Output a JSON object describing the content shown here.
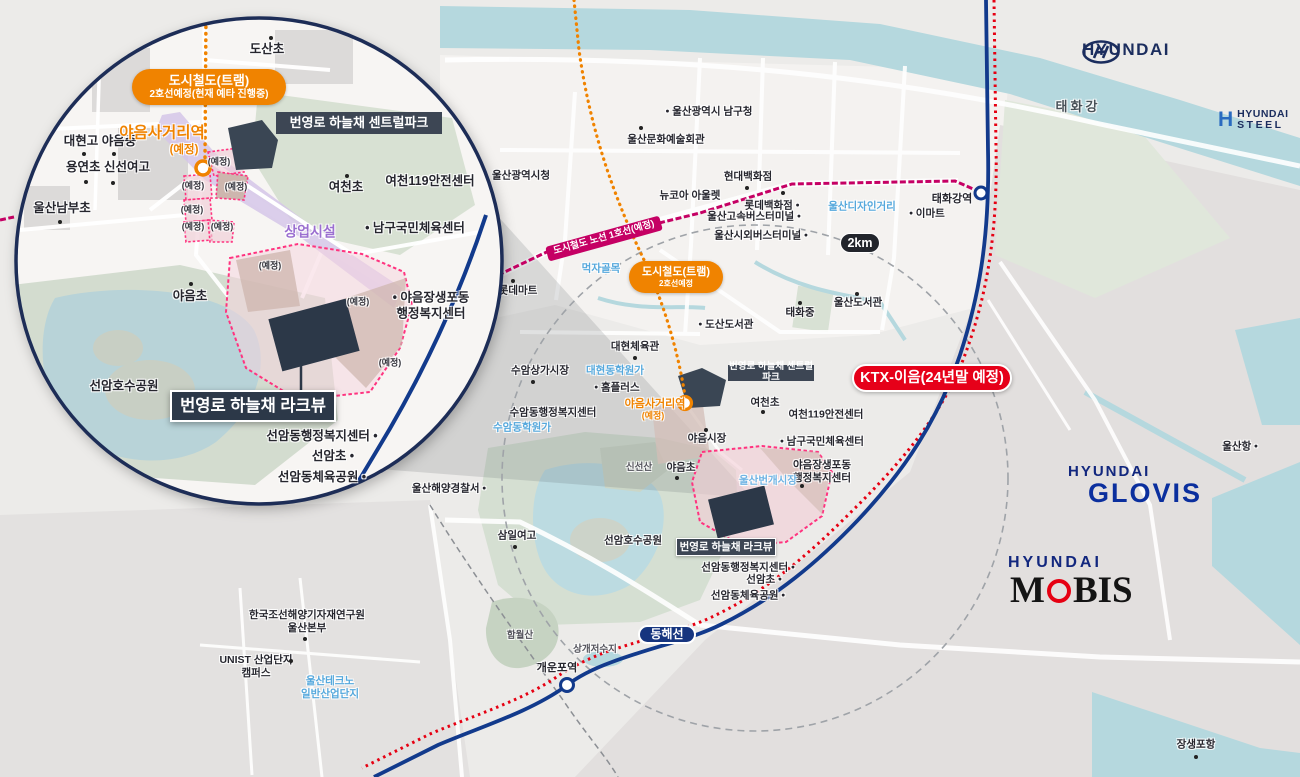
{
  "badges": {
    "inset_tram_l1": "도시철도(트램)",
    "inset_tram_l2": "2호선예정(현재 예타 진행중)",
    "map_tram_l1": "도시철도(트램)",
    "map_tram_l2": "2호선예정",
    "line1": "도시철도 노선 1호선(예정)",
    "centralpark": "번영로 하늘채 센트럴파크",
    "lakeview": "번영로 하늘채 라크뷰",
    "ktx": "KTX-이음(24년말 예정)",
    "donghae": "동해선",
    "km": "2km"
  },
  "stations": {
    "yaeum": "야음사거리역",
    "yaeum_note": "(예정)",
    "taehwagang": "태화강역",
    "gaeunpo": "개운포역"
  },
  "logos": {
    "hyundai": "HYUNDAI",
    "steel_l1": "HYUNDAI",
    "steel_l2": "STEEL",
    "steel_h": "H",
    "glovis_l1": "HYUNDAI",
    "glovis_l2": "GLOVIS",
    "mobis_l1": "HYUNDAI",
    "mobis_m": "M",
    "mobis_bis": "BIS"
  },
  "colors": {
    "orange": "#f08300",
    "magenta_line": "#c50064",
    "rail_blue": "#123a8c",
    "rail_red": "#e60012",
    "badge_dark": "#3d4654",
    "ktx_red": "#e60019",
    "donghae_navy": "#16357f",
    "parcel_pink": "#ff337f",
    "commercial_purple": "#d5c6e8",
    "water": "#b5d8de"
  },
  "map_labels": [
    {
      "t": "울산광역시청",
      "x": 521,
      "y": 176
    },
    {
      "t": "울산광역시 남구청",
      "x": 709,
      "y": 112,
      "d": "l"
    },
    {
      "t": "울산문화예술회관",
      "x": 666,
      "y": 140
    },
    {
      "t": "",
      "x": 641,
      "y": 128,
      "c": "dot"
    },
    {
      "t": "울산디자인거리",
      "x": 862,
      "y": 207,
      "c": "b"
    },
    {
      "t": "현대백화점",
      "x": 748,
      "y": 177
    },
    {
      "t": "",
      "x": 747,
      "y": 188,
      "c": "dot"
    },
    {
      "t": "뉴코아 아울렛",
      "x": 690,
      "y": 196
    },
    {
      "t": "",
      "x": 783,
      "y": 193,
      "c": "dot"
    },
    {
      "t": "롯데백화점",
      "x": 772,
      "y": 206,
      "d": "r"
    },
    {
      "t": "울산고속버스터미널",
      "x": 754,
      "y": 217,
      "d": "r"
    },
    {
      "t": "울산시외버스터미널",
      "x": 761,
      "y": 236,
      "d": "r"
    },
    {
      "t": "먹자골목",
      "x": 601,
      "y": 269,
      "c": "b"
    },
    {
      "t": "롯데마트",
      "x": 518,
      "y": 291
    },
    {
      "t": "",
      "x": 513,
      "y": 281,
      "c": "dot"
    },
    {
      "t": "울산도서관",
      "x": 858,
      "y": 303
    },
    {
      "t": "",
      "x": 857,
      "y": 294,
      "c": "dot"
    },
    {
      "t": "태화중",
      "x": 800,
      "y": 313
    },
    {
      "t": "",
      "x": 800,
      "y": 303,
      "c": "dot"
    },
    {
      "t": "도산도서관",
      "x": 726,
      "y": 325,
      "d": "l"
    },
    {
      "t": "대현체육관",
      "x": 635,
      "y": 347
    },
    {
      "t": "",
      "x": 635,
      "y": 358,
      "c": "dot"
    },
    {
      "t": "수암상가시장",
      "x": 540,
      "y": 371
    },
    {
      "t": "",
      "x": 533,
      "y": 382,
      "c": "dot"
    },
    {
      "t": "대현동학원가",
      "x": 615,
      "y": 371,
      "c": "b"
    },
    {
      "t": "홈플러스",
      "x": 617,
      "y": 388,
      "d": "l"
    },
    {
      "t": "수암동행정복지센터",
      "x": 553,
      "y": 413
    },
    {
      "t": "수암동학원가",
      "x": 522,
      "y": 428,
      "c": "b"
    },
    {
      "t": "야음사거리역",
      "x": 655,
      "y": 405,
      "c": "o"
    },
    {
      "t": "(예정)",
      "x": 653,
      "y": 416,
      "c": "o2"
    },
    {
      "t": "야음시장",
      "x": 707,
      "y": 439
    },
    {
      "t": "",
      "x": 706,
      "y": 430,
      "c": "dot"
    },
    {
      "t": "신선산",
      "x": 639,
      "y": 468,
      "c": "sm"
    },
    {
      "t": "야음초",
      "x": 681,
      "y": 468
    },
    {
      "t": "",
      "x": 677,
      "y": 478,
      "c": "dot"
    },
    {
      "t": "여천초",
      "x": 765,
      "y": 403
    },
    {
      "t": "",
      "x": 763,
      "y": 412,
      "c": "dot"
    },
    {
      "t": "여천119안전센터",
      "x": 826,
      "y": 415
    },
    {
      "t": "남구국민체육센터",
      "x": 822,
      "y": 442,
      "d": "l"
    },
    {
      "t": "야음장생포동\n행정복지센터",
      "x": 822,
      "y": 472
    },
    {
      "t": "",
      "x": 802,
      "y": 486,
      "c": "dot"
    },
    {
      "t": "울산번개시장",
      "x": 768,
      "y": 481,
      "c": "bw"
    },
    {
      "t": "태화강역",
      "x": 952,
      "y": 200,
      "c": "sta"
    },
    {
      "t": "이마트",
      "x": 927,
      "y": 214,
      "d": "l"
    },
    {
      "t": "울산항",
      "x": 1240,
      "y": 447,
      "d": "r"
    },
    {
      "t": "삼일여고",
      "x": 517,
      "y": 536
    },
    {
      "t": "",
      "x": 515,
      "y": 547,
      "c": "dot"
    },
    {
      "t": "선암호수공원",
      "x": 633,
      "y": 541
    },
    {
      "t": "선암동행정복지센터",
      "x": 748,
      "y": 568,
      "d": "r"
    },
    {
      "t": "선암초",
      "x": 764,
      "y": 580,
      "d": "r"
    },
    {
      "t": "선암동체육공원",
      "x": 748,
      "y": 596,
      "d": "r"
    },
    {
      "t": "울산해양경찰서",
      "x": 449,
      "y": 489,
      "d": "r"
    },
    {
      "t": "함월산",
      "x": 520,
      "y": 636,
      "c": "sm"
    },
    {
      "t": "상개저수지",
      "x": 595,
      "y": 650,
      "c": "sm"
    },
    {
      "t": "개운포역",
      "x": 557,
      "y": 669,
      "c": "sta"
    },
    {
      "t": "한국조선해양기자재연구원\n울산본부",
      "x": 307,
      "y": 622
    },
    {
      "t": "",
      "x": 305,
      "y": 639,
      "c": "dot"
    },
    {
      "t": "UNIST 산업단지\n캠퍼스",
      "x": 256,
      "y": 667
    },
    {
      "t": "",
      "x": 291,
      "y": 661,
      "c": "dot"
    },
    {
      "t": "울산테크노\n일반산업단지",
      "x": 330,
      "y": 688,
      "c": "b"
    },
    {
      "t": "장생포항",
      "x": 1196,
      "y": 745
    },
    {
      "t": "",
      "x": 1196,
      "y": 757,
      "c": "dot"
    },
    {
      "t": "태화강",
      "x": 1078,
      "y": 107,
      "c": "rv"
    }
  ],
  "inset_labels": [
    {
      "t": "도산초",
      "x": 267,
      "y": 50,
      "c": "i"
    },
    {
      "t": "",
      "x": 271,
      "y": 38,
      "c": "dot"
    },
    {
      "t": "대현고  야음중",
      "x": 100,
      "y": 142,
      "c": "i"
    },
    {
      "t": "",
      "x": 84,
      "y": 154,
      "c": "dot"
    },
    {
      "t": "",
      "x": 114,
      "y": 154,
      "c": "dot"
    },
    {
      "t": "용연초  신선여고",
      "x": 108,
      "y": 168,
      "c": "i"
    },
    {
      "t": "",
      "x": 86,
      "y": 182,
      "c": "dot"
    },
    {
      "t": "",
      "x": 113,
      "y": 183,
      "c": "dot"
    },
    {
      "t": "울산남부초",
      "x": 62,
      "y": 209,
      "c": "i"
    },
    {
      "t": "",
      "x": 60,
      "y": 222,
      "c": "dot"
    },
    {
      "t": "야음사거리역",
      "x": 162,
      "y": 133,
      "c": "oi"
    },
    {
      "t": "(예정)",
      "x": 184,
      "y": 150,
      "c": "o2i"
    },
    {
      "t": "여천초",
      "x": 346,
      "y": 188,
      "c": "i"
    },
    {
      "t": "",
      "x": 347,
      "y": 176,
      "c": "dot"
    },
    {
      "t": "여천119안전센터",
      "x": 430,
      "y": 182,
      "c": "i"
    },
    {
      "t": "남구국민체육센터",
      "x": 415,
      "y": 229,
      "c": "i",
      "d": "l"
    },
    {
      "t": "상업시설",
      "x": 310,
      "y": 232,
      "c": "p"
    },
    {
      "t": "(예정)",
      "x": 219,
      "y": 162,
      "c": "ye"
    },
    {
      "t": "(예정)",
      "x": 236,
      "y": 187,
      "c": "ye"
    },
    {
      "t": "(예정)",
      "x": 193,
      "y": 186,
      "c": "ye"
    },
    {
      "t": "(예정)",
      "x": 192,
      "y": 210,
      "c": "ye"
    },
    {
      "t": "(예정)",
      "x": 193,
      "y": 227,
      "c": "ye"
    },
    {
      "t": "(예정)",
      "x": 222,
      "y": 227,
      "c": "ye"
    },
    {
      "t": "(예정)",
      "x": 270,
      "y": 266,
      "c": "ye"
    },
    {
      "t": "(예정)",
      "x": 358,
      "y": 302,
      "c": "ye"
    },
    {
      "t": "(예정)",
      "x": 390,
      "y": 363,
      "c": "ye"
    },
    {
      "t": "야음초",
      "x": 190,
      "y": 297,
      "c": "i"
    },
    {
      "t": "",
      "x": 191,
      "y": 284,
      "c": "dot"
    },
    {
      "t": "선암호수공원",
      "x": 124,
      "y": 387,
      "c": "i"
    },
    {
      "t": "야음장생포동\n행정복지센터",
      "x": 431,
      "y": 306,
      "c": "i",
      "d": "l"
    },
    {
      "t": "선암동행정복지센터",
      "x": 322,
      "y": 437,
      "c": "i",
      "d": "r"
    },
    {
      "t": "선암초",
      "x": 333,
      "y": 457,
      "c": "i",
      "d": "r"
    },
    {
      "t": "선암동체육공원",
      "x": 322,
      "y": 478,
      "c": "i",
      "d": "r"
    }
  ]
}
